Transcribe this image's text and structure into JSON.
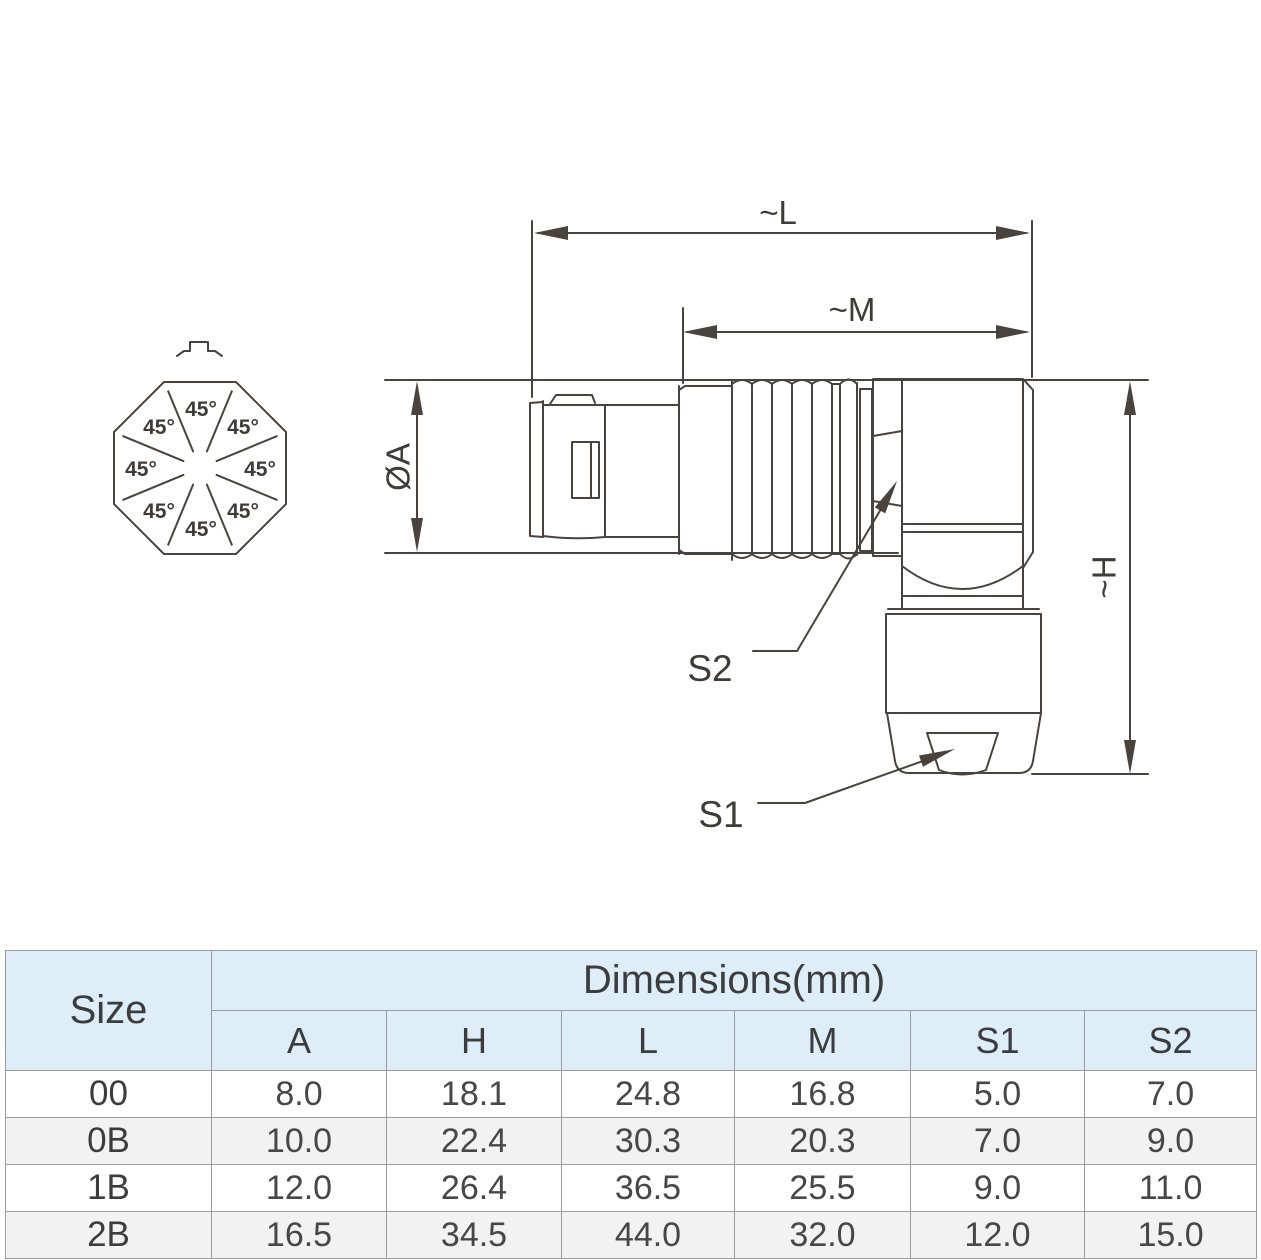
{
  "drawing": {
    "angle_label": "45°",
    "dim_l": "~L",
    "dim_m": "~M",
    "dim_a": "ØA",
    "dim_h": "~H",
    "s1": "S1",
    "s2": "S2"
  },
  "table": {
    "size_header": "Size",
    "group_header": "Dimensions(mm)",
    "columns": [
      "A",
      "H",
      "L",
      "M",
      "S1",
      "S2"
    ],
    "rows": [
      {
        "size": "00",
        "values": [
          "8.0",
          "18.1",
          "24.8",
          "16.8",
          "5.0",
          "7.0"
        ]
      },
      {
        "size": "0B",
        "values": [
          "10.0",
          "22.4",
          "30.3",
          "20.3",
          "7.0",
          "9.0"
        ]
      },
      {
        "size": "1B",
        "values": [
          "12.0",
          "26.4",
          "36.5",
          "25.5",
          "9.0",
          "11.0"
        ]
      },
      {
        "size": "2B",
        "values": [
          "16.5",
          "34.5",
          "44.0",
          "32.0",
          "12.0",
          "15.0"
        ]
      }
    ]
  },
  "colors": {
    "line": "#4a433d",
    "text": "#3f3b37",
    "table_header_bg": "#ddeef9",
    "table_stripe_bg": "#f2f2f2",
    "table_border": "#9b9b9b"
  }
}
